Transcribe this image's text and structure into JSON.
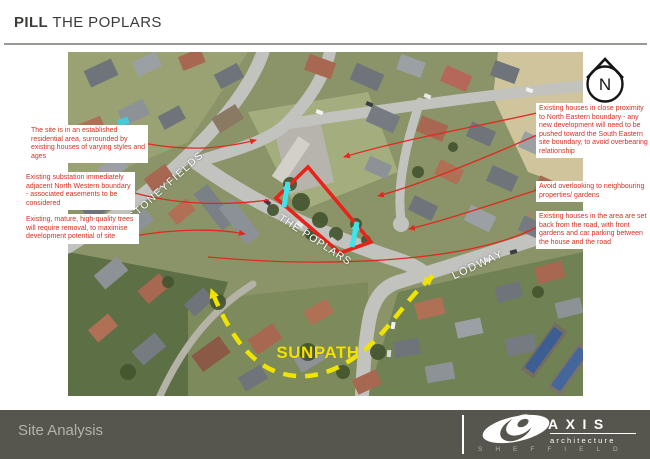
{
  "header": {
    "title_bold": "PILL",
    "title_rest": "THE POPLARS"
  },
  "annotations": {
    "left": [
      {
        "text": "The site is in an established residential area, surrounded by existing houses of varying styles and ages"
      },
      {
        "text": "Existing substation immediately adjacent North Western boundary - associated easements to be considered"
      },
      {
        "text": "Existing, mature, high-quality trees will require removal, to maximise development potential of site"
      }
    ],
    "right": [
      {
        "text": "Existing houses in close proximity to North Eastern boundary - any new development will need to be pushed toward the South Eastern site boundary, to avoid overbearing relationship"
      },
      {
        "text": "Avoid overlooking to neighbouring properties/ gardens"
      },
      {
        "text": "Existing houses in the area are set back from the road, with front gardens and car parking between the house and the road"
      }
    ]
  },
  "map": {
    "street_labels": [
      {
        "text": "STONEYFIELDS"
      },
      {
        "text": "THE POPLARS"
      },
      {
        "text": "LODWAY"
      }
    ],
    "sunpath_label": "SUNPATH",
    "north_label": "N",
    "colors": {
      "site_outline": "#e8231a",
      "annotation_text": "#d92f23",
      "sunpath_yellow": "#f0e300",
      "view_arrow_cyan": "#3fe3ea",
      "footer_bg": "#56554e"
    }
  },
  "footer": {
    "title": "Site Analysis",
    "brand": {
      "name": "AXIS",
      "subtitle": "architecture",
      "city": "SHEFFIELD"
    }
  }
}
